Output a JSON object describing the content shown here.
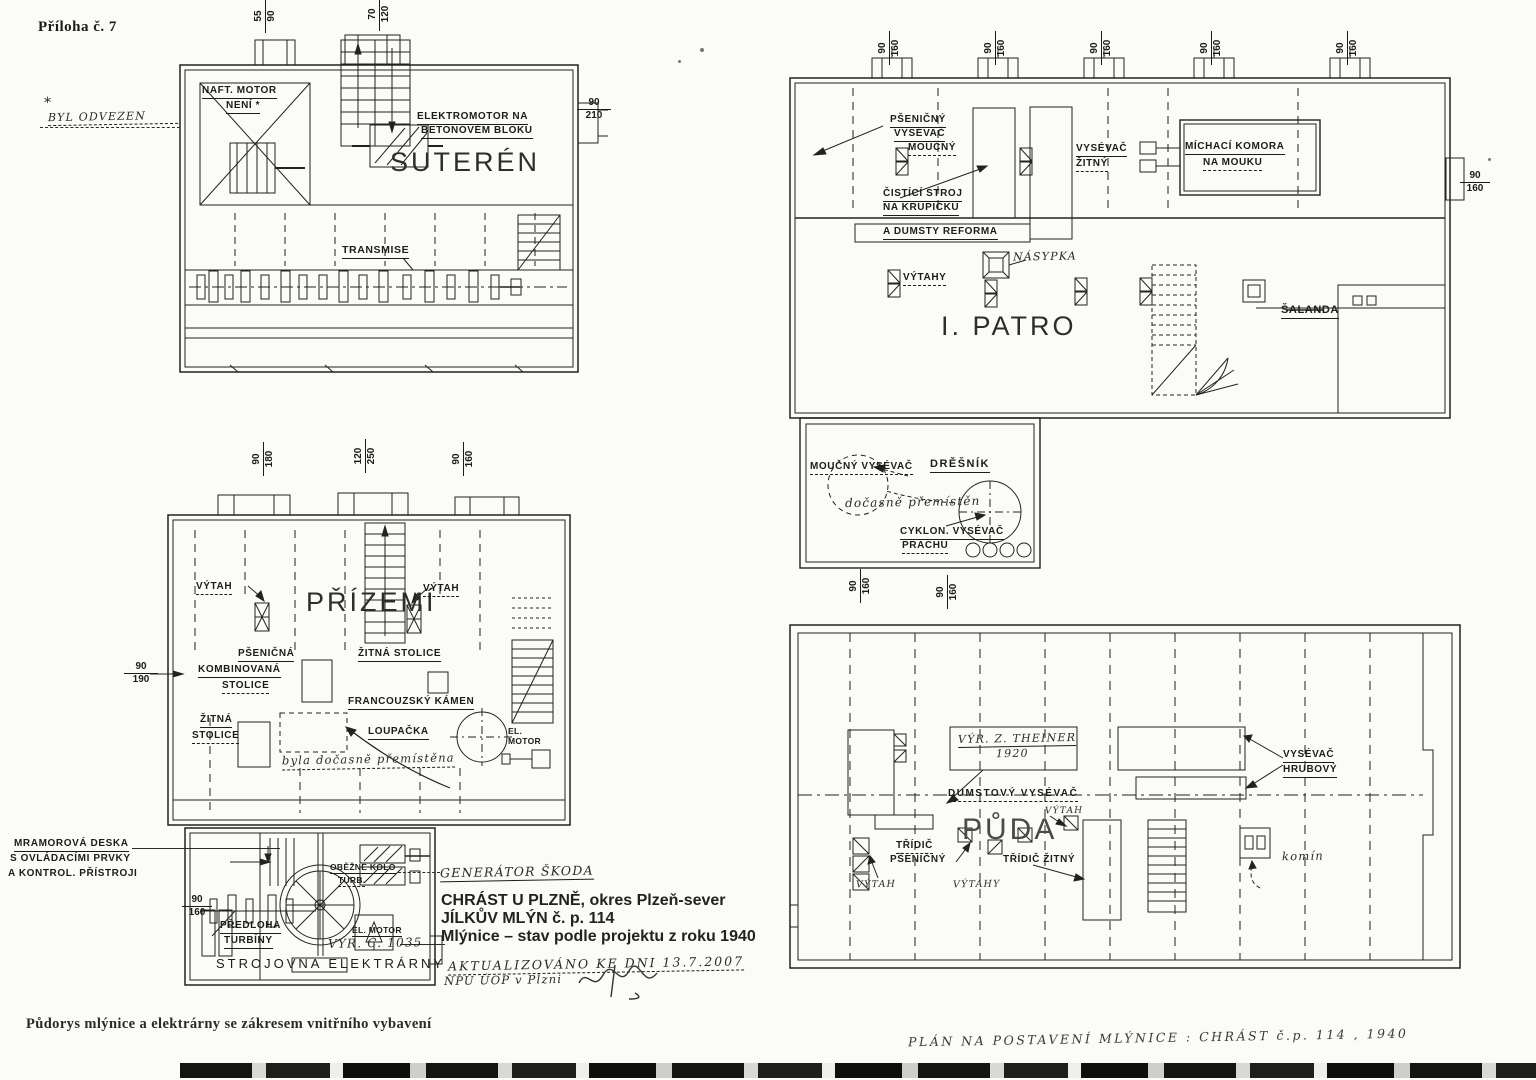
{
  "colors": {
    "paper": "#fbfbf8",
    "ink": "#1c1c1c"
  },
  "annotations": {
    "priloha": "Příloha č. 7",
    "star": "*",
    "byl_odvezen": "BYL ODVEZEN",
    "caption": "Půdorys mlýnice a elektrárny se zákresem vnitřního vybavení",
    "plan_note": "PLÁN NA POSTAVENÍ MLÝNICE : CHRÁST č.p. 114 , 1940"
  },
  "title_block": {
    "line1": "CHRÁST U PLZNĚ, okres Plzeň-sever",
    "line2": "JÍLKŮV MLÝN č. p. 114",
    "line3": "Mlýnice – stav podle projektu z roku 1940",
    "updated1": "AKTUALIZOVÁNO KE DNI 13.7.2007",
    "updated2": "NPÚ ÚOP v Plzni"
  },
  "suteren": {
    "title": "SUTERÉN",
    "naft_motor": "NAFT. MOTOR",
    "neni": "NENÍ *",
    "elektromotor1": "ELEKTROMOTOR NA",
    "elektromotor2": "BETONOVÉM BLOKU",
    "transmise": "TRANSMISE"
  },
  "prizemi": {
    "title": "PŘÍZEMÍ",
    "vytah_l": "VÝTAH",
    "vytah_r": "VÝTAH",
    "psenicna1": "PŠENIČNÁ",
    "psenicna2": "KOMBINOVANÁ",
    "psenicna3": "STOLICE",
    "zitna_stolice": "ŽITNÁ STOLICE",
    "zitna1": "ŽITNÁ",
    "zitna2": "STOLICE",
    "francouzsky": "FRANCOUZSKÝ KÁMEN",
    "loupacka": "LOUPAČKA",
    "presun": "byla dočasně přemístěna",
    "el_motor": "EL.\nMOTOR"
  },
  "strojovna": {
    "title": "STROJOVNA ELEKTRÁRNY",
    "mramorova1": "MRAMOROVÁ DESKA",
    "mramorova2": "S OVLÁDACÍMI PRVKY",
    "mramorova3": "A KONTROL. PŘÍSTROJI",
    "predloha1": "PŘEDLOHA",
    "predloha2": "TURBÍNY",
    "obezne1": "OBĚŽNÉ KOLO",
    "obezne2": "TURB.",
    "generator": "GENERÁTOR ŠKODA",
    "el_motor": "EL. MOTOR",
    "vyr_c": "VÝR. Č. 1035"
  },
  "patro": {
    "title": "I. PATRO",
    "psenicny1": "PŠENIČNÝ",
    "psenicny2": "VYSÉVAČ",
    "psenicny3": "MOUČNÝ",
    "cistici1": "ČISTÍCÍ STROJ",
    "cistici2": "NA KRUPIČKU",
    "dumsty": "A DUMSTY REFORMA",
    "vysevac_zitny1": "VYSÉVAČ",
    "vysevac_zitny2": "ŽITNÝ",
    "michaci1": "MÍCHACÍ KOMORA",
    "michaci2": "NA MOUKU",
    "nasypka": "NÁSYPKA",
    "vytahy": "VÝTAHY",
    "salanda": "ŠALANDA",
    "moucny": "MOUČNÝ VYSÉVAČ",
    "dresnik": "DRĚŠNÍK",
    "docasne": "dočasně přemístěn",
    "cyklon1": "CYKLON. VYSÉVAČ",
    "cyklon2": "PRACHU"
  },
  "puda": {
    "title": "PŮDA",
    "vyr_theiner1": "VÝR. Z. THEINER",
    "vyr_theiner2": "1920",
    "dumstovy": "DUMSTOVÝ VYSÉVAČ",
    "tridic_ps1": "TŘÍDIČ",
    "tridic_ps2": "PŠENIČNÝ",
    "tridic_zitny": "TŘÍDIČ ŽITNÝ",
    "vytah_l": "VÝTAH",
    "vytah_c": "VÝTAHY",
    "vytah_t": "VÝTAH",
    "vysevac_hrubovy1": "VYSÉVAČ",
    "vysevac_hrubovy2": "HRUBOVÝ",
    "komin": "komín"
  },
  "dims": {
    "n55": "55",
    "n70": "70",
    "n90": "90",
    "n120": "120",
    "n160": "160",
    "n180": "180",
    "n190": "190",
    "n210": "210",
    "n250": "250"
  }
}
